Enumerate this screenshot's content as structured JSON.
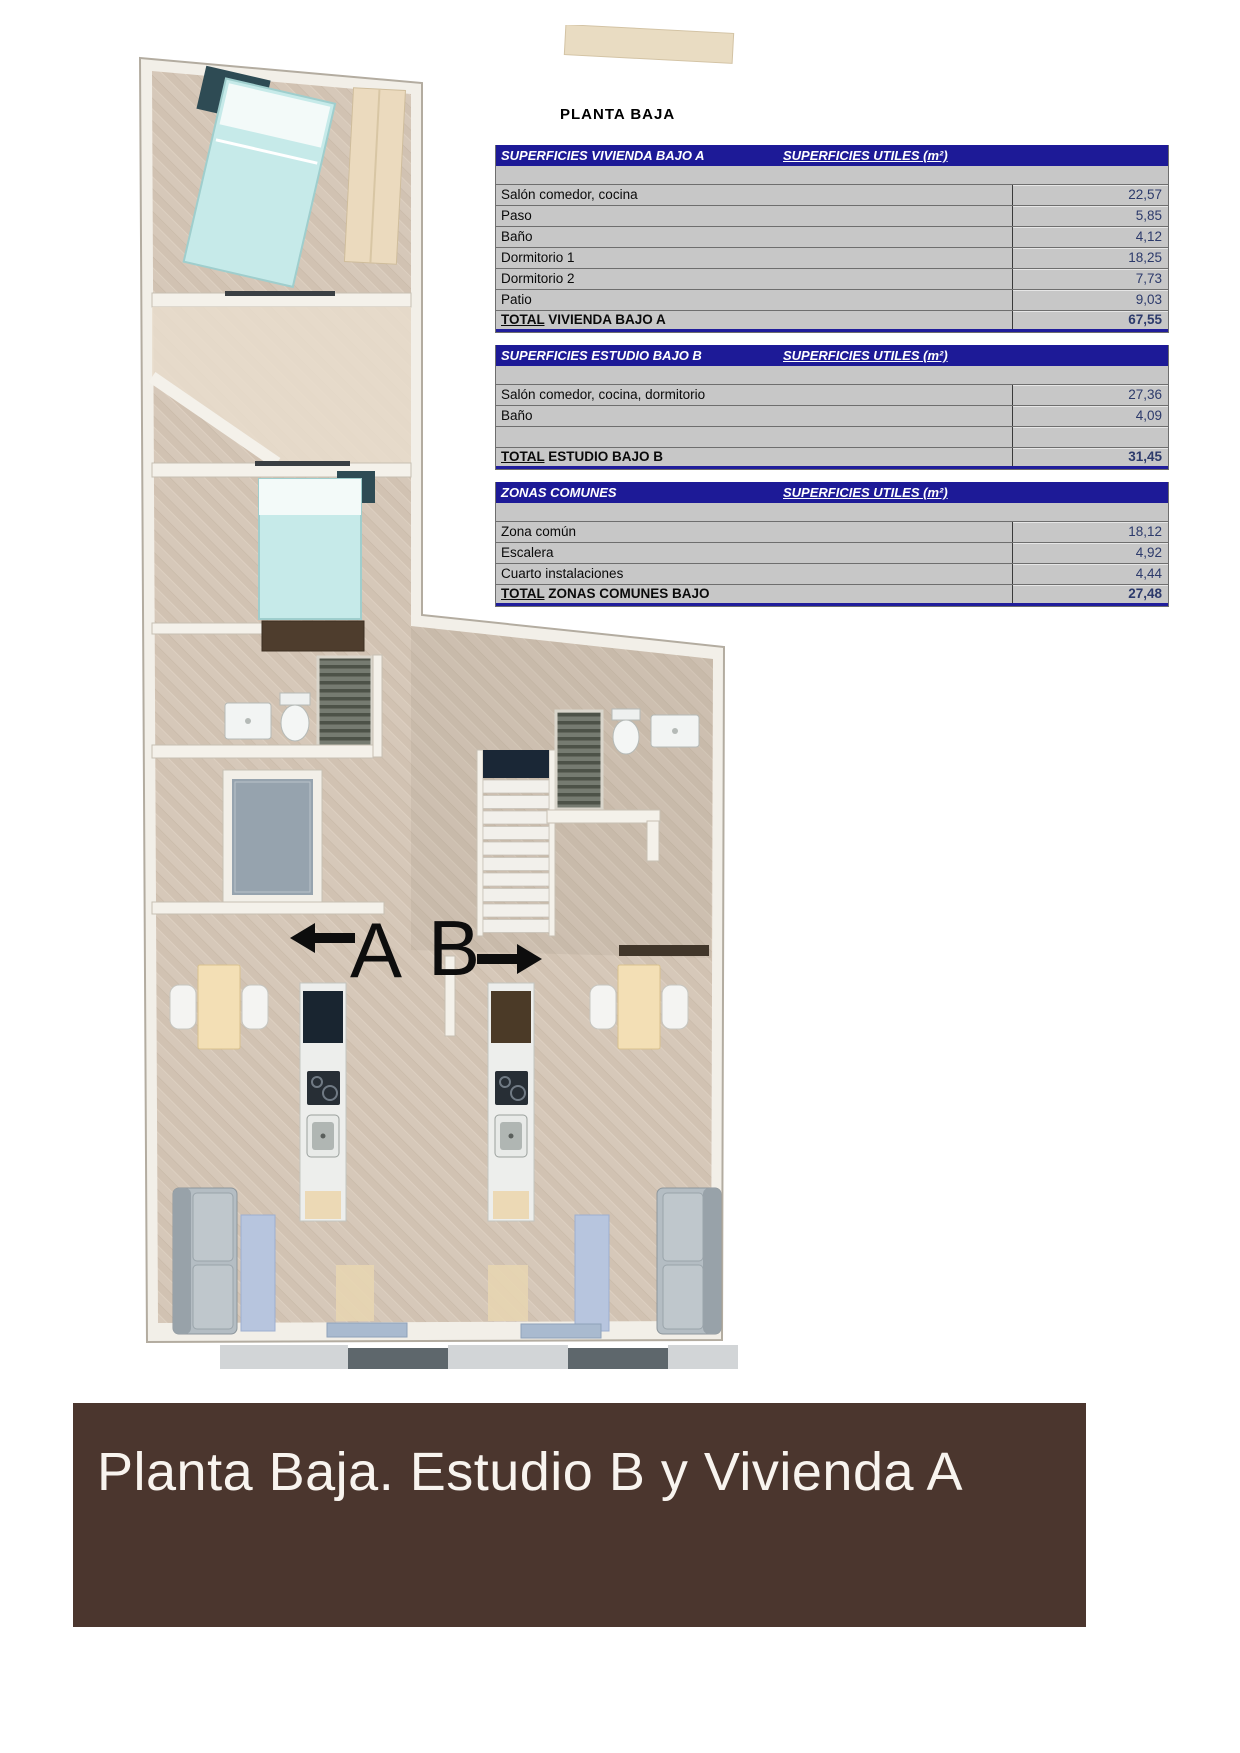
{
  "floor_plan": {
    "unit_a_label": "A",
    "unit_b_label": "B"
  },
  "tables_section": {
    "title": "PLANTA BAJA",
    "tables": [
      {
        "title": "SUPERFICIES VIVIENDA BAJO A",
        "units_header": "SUPERFICIES UTILES  (m²)",
        "rows": [
          {
            "label": "Salón comedor, cocina",
            "value": "22,57"
          },
          {
            "label": "Paso",
            "value": "5,85"
          },
          {
            "label": "Baño",
            "value": "4,12"
          },
          {
            "label": "Dormitorio 1",
            "value": "18,25"
          },
          {
            "label": "Dormitorio 2",
            "value": "7,73"
          },
          {
            "label": "Patio",
            "value": "9,03"
          }
        ],
        "total": {
          "word": "TOTAL",
          "rest": " VIVIENDA BAJO A",
          "value": "67,55"
        }
      },
      {
        "title": "SUPERFICIES ESTUDIO BAJO B",
        "units_header": "SUPERFICIES UTILES  (m²)",
        "rows": [
          {
            "label": "Salón comedor, cocina, dormitorio",
            "value": "27,36"
          },
          {
            "label": "Baño",
            "value": "4,09"
          },
          {
            "label": "",
            "value": ""
          }
        ],
        "total": {
          "word": "TOTAL",
          "rest": " ESTUDIO BAJO B",
          "value": "31,45"
        }
      },
      {
        "title": "ZONAS COMUNES",
        "units_header": "SUPERFICIES UTILES  (m²)",
        "rows": [
          {
            "label": "Zona común",
            "value": "18,12"
          },
          {
            "label": "Escalera",
            "value": "4,92"
          },
          {
            "label": "Cuarto instalaciones",
            "value": "4,44"
          }
        ],
        "total": {
          "word": "TOTAL",
          "rest": " ZONAS COMUNES BAJO",
          "value": "27,48"
        }
      }
    ]
  },
  "footer": {
    "caption": "Planta Baja. Estudio B y Vivienda A"
  },
  "colors": {
    "header_navy": "#1d1a97",
    "cell_gray": "#c7c7c7",
    "value_text": "#2c3a6b",
    "banner_brown": "#4b362e",
    "floor_beige": "#d6c8b9",
    "patio_gray": "#96a3ae",
    "mattress_cyan": "#c6eae9"
  }
}
